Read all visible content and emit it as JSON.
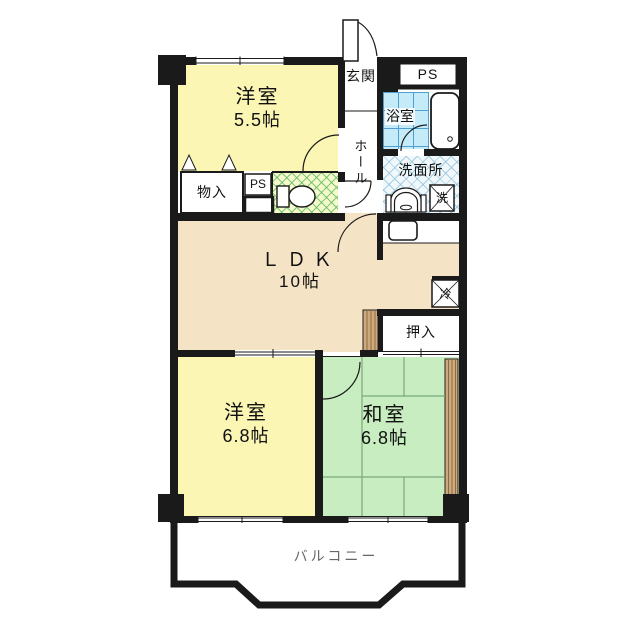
{
  "plan": {
    "type": "apartment-floor-plan",
    "rooms": {
      "western1": {
        "name": "洋室",
        "size": "5.5帖"
      },
      "western2": {
        "name": "洋室",
        "size": "6.8帖"
      },
      "japanese": {
        "name": "和室",
        "size": "6.8帖"
      },
      "ldk": {
        "name": "ＬＤＫ",
        "size": "10帖"
      }
    },
    "labels": {
      "entrance": "玄関",
      "ps_top": "PS",
      "ps_small": "PS",
      "bath": "浴室",
      "hall": "ホール",
      "washroom": "洗面所",
      "washer": "洗",
      "storage": "物入",
      "fridge": "冷",
      "closet": "押入",
      "balcony": "バルコニー"
    },
    "colors": {
      "wall": "#1a1a1a",
      "western_room_fill": "#fbf6b4",
      "ldk_fill": "#f5e3c6",
      "japanese_room_fill": "#c8edc0",
      "bath_tile_fill": "#c6ebf8",
      "washroom_fill": "#f0f8fb",
      "toilet_fill": "#f6f8cd",
      "wood_strip_fill": "#cfa97c",
      "balcony_text": "#666666"
    }
  }
}
